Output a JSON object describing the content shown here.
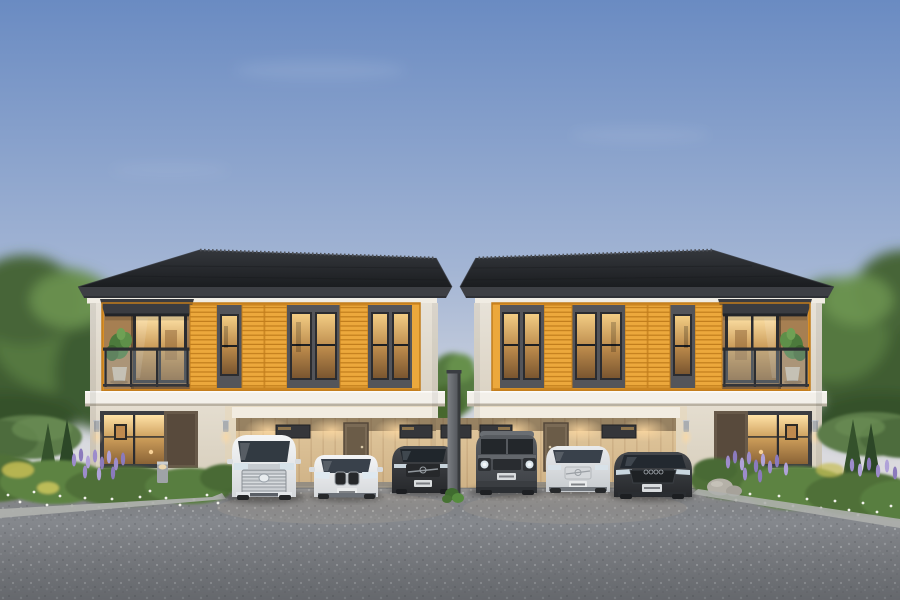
{
  "scene": {
    "setting": "Twin two-storey duplex houses with orange timber-slat facades at dusk",
    "sky": "clear dusk sky fading to a warm horizon",
    "left_house_label": "left duplex house with outer-left balcony and 3-car carport",
    "right_house_label": "right duplex house with outer-right balcony and 3-car carport",
    "cars": [
      {
        "label": "white luxury MPV van",
        "color": "white"
      },
      {
        "label": "white compact SUV",
        "color": "white"
      },
      {
        "label": "dark grey sedan",
        "color": "dark-grey"
      },
      {
        "label": "grey boxy off-road SUV",
        "color": "grey"
      },
      {
        "label": "white crossover SUV",
        "color": "white"
      },
      {
        "label": "dark grey sports sedan",
        "color": "dark-grey"
      }
    ],
    "garden_left": "trimmed hedge, conical shrubs, purple flower spikes, white ground flowers",
    "garden_right": "trimmed hedge, conical shrubs, purple flower spikes, white ground flowers",
    "foreground": "grey exposed-aggregate driveway",
    "divider": "dark fence post between the two lots"
  },
  "palette": {
    "sky-top": "#6a8bc2",
    "sky-mid": "#a3b5d4",
    "sky-low": "#d7d9e0",
    "sky-horizon": "#eadfd4",
    "roof-top": "#34373c",
    "roof-bottom": "#1b1d20",
    "fascia": "#3d3f44",
    "wall-upper": "#e7e2d8",
    "wall-lower": "#d6cdbb",
    "band-white": "#f3f0ea",
    "orange": "#eca83c",
    "orange-deep": "#d98f26",
    "orange-line": "#c17d1c",
    "window-dark": "#54555a",
    "frame-dark": "#2b2c30",
    "glass-1": "#f3cd84",
    "glass-2": "#b9884a",
    "glass-3": "#7a5630",
    "carport-1": "#e6cda3",
    "carport-2": "#c3a478",
    "awning": "#3a3c41",
    "tree-dark": "#3f5d33",
    "tree-mid": "#547840",
    "tree-light": "#6f9854",
    "hedge": "#5b7b48",
    "bed": "#4f7038",
    "bed-light": "#6b9349",
    "flower-purple": "#9d8ccb",
    "flower-white": "#f2f2ec",
    "flower-yellow": "#c6bd54",
    "asphalt": "#85888d",
    "curb": "#aeb0ad",
    "glow": "#ffd9a0",
    "car-white-1": "#f4f5f6",
    "car-white-2": "#d5d8db",
    "car-dark-1": "#45484d",
    "car-dark-2": "#26282b",
    "car-grey-1": "#585c61",
    "car-grey-2": "#3c3f44"
  }
}
